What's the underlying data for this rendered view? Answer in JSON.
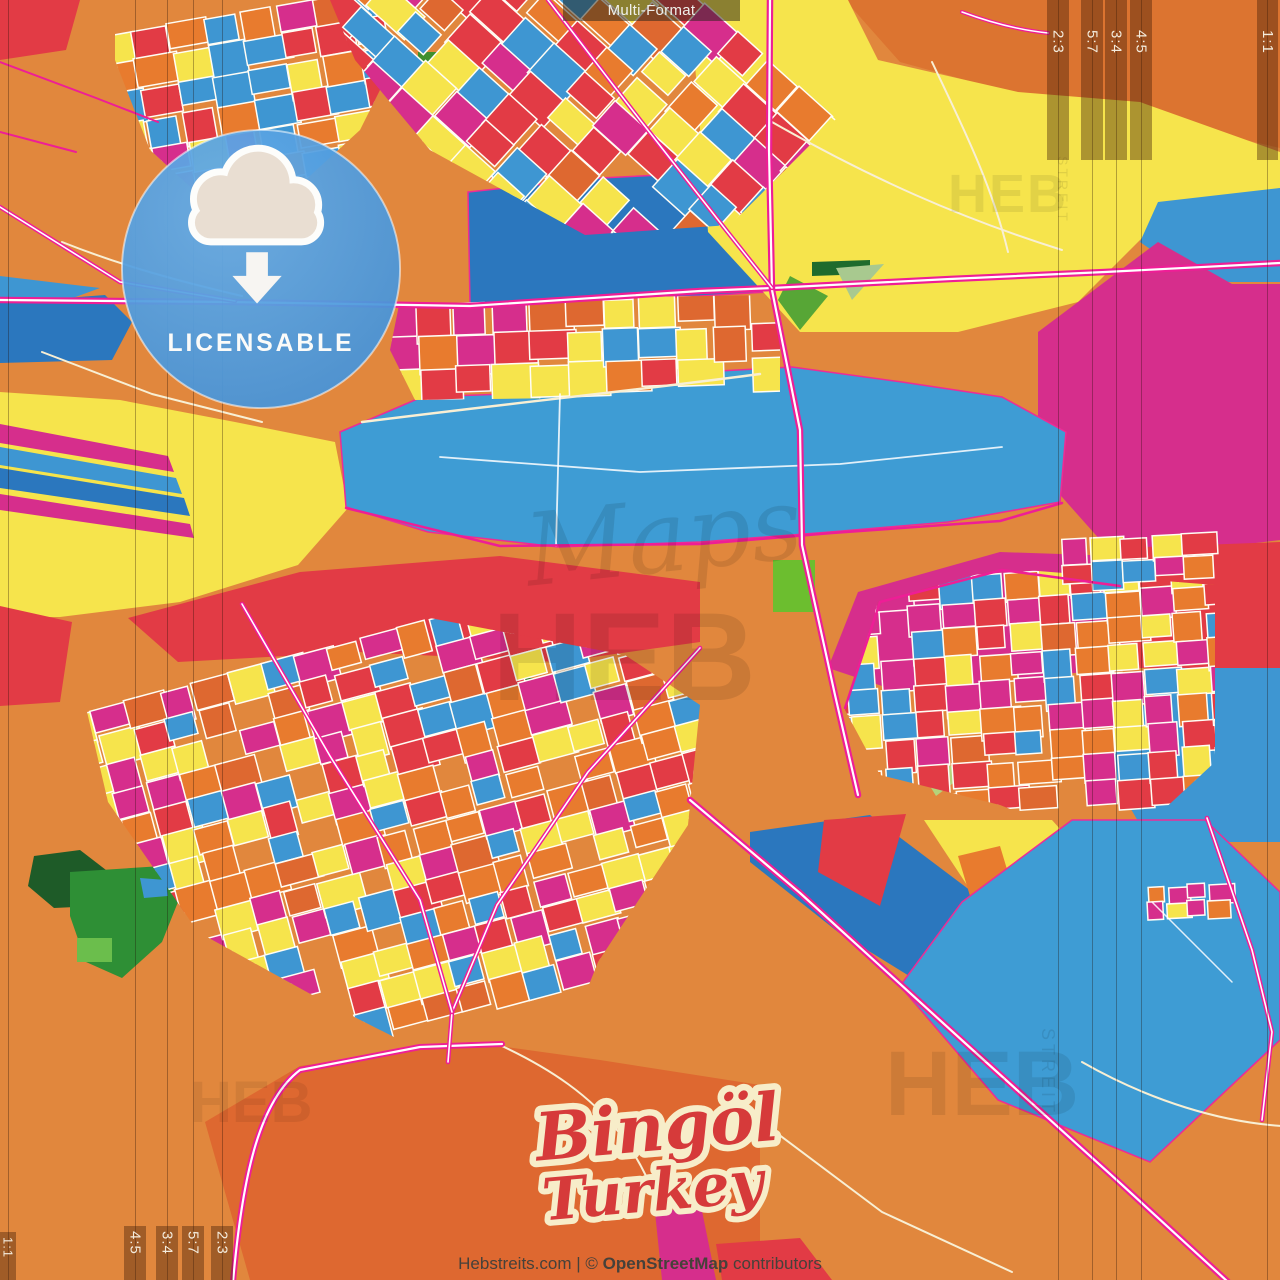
{
  "poster": {
    "format_label": "Multi-Format"
  },
  "ratios": {
    "top_right": [
      "2:3",
      "5:7",
      "3:4",
      "4:5",
      "1:1"
    ],
    "bottom_left": [
      "1:1",
      "4:5",
      "3:4",
      "5:7",
      "2:3"
    ]
  },
  "badge": {
    "label": "LICENSABLE",
    "icon": "cloud-download-icon"
  },
  "title": {
    "city": "Bingöl",
    "country": "Turkey"
  },
  "attribution": {
    "prefix": "Hebstreits.com | ©",
    "osm": "OpenStreetMap",
    "suffix": "contributors"
  },
  "watermarks": {
    "brand": "HEB",
    "brand_vertical": "STREIT",
    "script": "Maps"
  },
  "colors": {
    "orange_bg": "#E1873D",
    "orange_deep": "#DE6830",
    "orange_blob": "#DC7430",
    "orange_mid": "#E87B2E",
    "yellow": "#F6E44C",
    "red": "#E23B45",
    "magenta": "#D62E8C",
    "road_magenta": "#EE1E96",
    "blue": "#3E96D2",
    "blue_dark": "#2B77BE",
    "lake_blue": "#3E9CD4",
    "green_dark": "#1E5B28",
    "green_mid": "#2E8F35",
    "green_bright": "#6CBE2F",
    "green_pale": "#B5D37A",
    "cream": "#F8EFD4",
    "street_white": "#FFFFFF",
    "badge_blue": "#4D9DE0",
    "title_red": "#D63A3A",
    "title_outline": "#F7EDC9",
    "attribution_text": "#46413A"
  }
}
